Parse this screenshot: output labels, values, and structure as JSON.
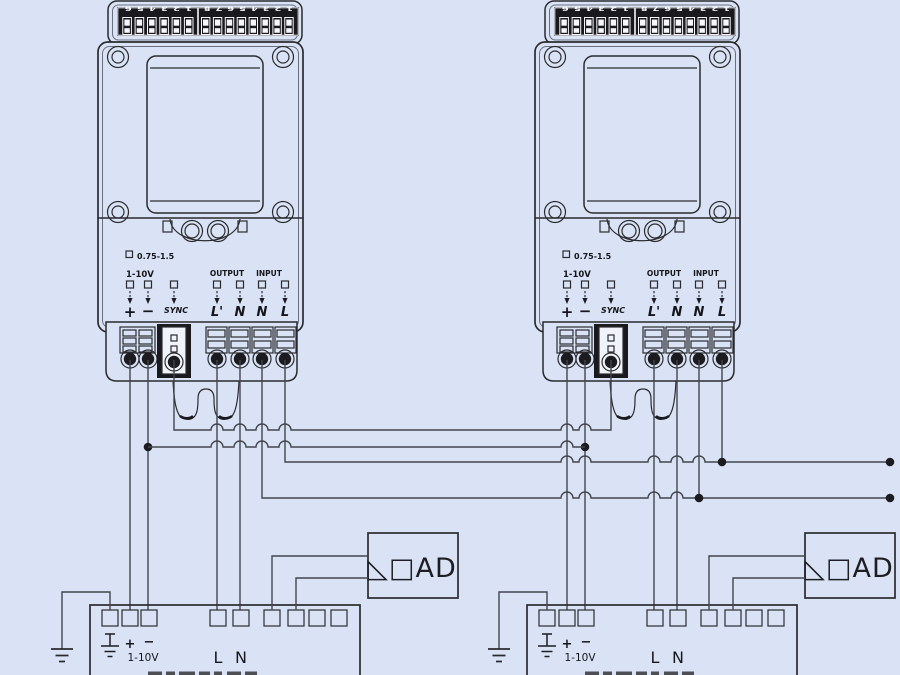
{
  "colors": {
    "background": "#d9e3f5",
    "line": "#2b2b2e",
    "wire": "#43454c",
    "dark_fill": "#1a1a1e",
    "white": "#f5f7fb"
  },
  "device": {
    "dip_bank_left": {
      "numbers": "1 2 3 4 5 6",
      "switch_count": 6,
      "orientation": "rotated-180"
    },
    "dip_bank_right": {
      "numbers": "1 2 3 4 5 6 7 8",
      "switch_count": 8,
      "orientation": "rotated-180"
    },
    "wire_gauge": "0.75-1.5",
    "control_range": "1-10V",
    "output_group_label": "OUTPUT",
    "input_group_label": "INPUT",
    "terminal_labels": {
      "plus": "+",
      "minus": "−",
      "sync": "SYNC",
      "l_out": "L'",
      "n_out": "N",
      "n_in": "N",
      "l_in": "L"
    }
  },
  "driver": {
    "terminal_labels": {
      "earth": "⏚",
      "plus": "+",
      "minus": "−",
      "range": "1-10V",
      "line": "L",
      "neutral": "N"
    },
    "terminal_count": 9
  },
  "load": {
    "label": "LOAD",
    "display": "◺□AD"
  }
}
